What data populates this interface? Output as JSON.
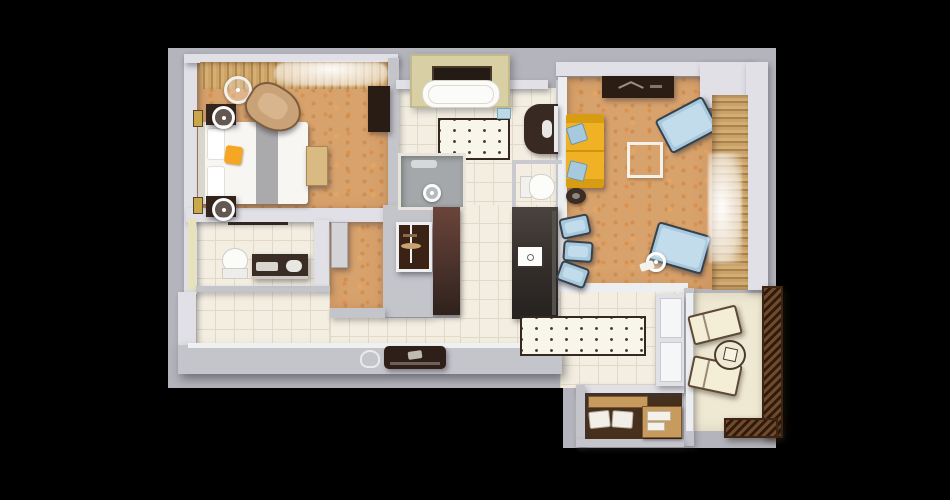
{
  "title": "3D apartment floor plan, top-down view",
  "palette": {
    "background": "#000000",
    "canvas": "#b4b4bc",
    "wall_light": "#e0e0e6",
    "wall_mid": "#c4c4cb",
    "carpet": "#d8a26c",
    "tile": "#f3eee1",
    "tile_line": "#e2dac7",
    "wood": "#c99f63",
    "dark_furniture": "#33241c",
    "sofa_yellow": "#f1b125",
    "chair_blue": "#a7c9de",
    "balcony_floor": "#efe9d4",
    "railing_brown": "#5c3a22",
    "closet_floor": "#47301d",
    "closet_wood": "#c79a5e",
    "accent_orange": "#f5a623",
    "shower_gray": "#a4a8aa"
  },
  "rooms": [
    {
      "name": "bedroom",
      "floor": "orange speckled carpet",
      "furniture": [
        "double bed with white duvet, gray runner and orange cushion",
        "nightstand with round lamp (x2)",
        "gold wall art (x2)",
        "tan armchair",
        "floor lamp",
        "foot bench",
        "dark wardrobe",
        "window strip with wood slats and sheer curtain",
        "gray dresser"
      ]
    },
    {
      "name": "main-bathroom",
      "floor": "cream tile",
      "furniture": [
        "bathtub in alcove with window",
        "dotted bath mat",
        "dark vanity with sink and mirror",
        "blue towel",
        "gray shower",
        "toilet"
      ]
    },
    {
      "name": "second-bathroom",
      "floor": "cream tile",
      "furniture": [
        "toilet",
        "dark vanity with sink",
        "towel rail",
        "white door"
      ]
    },
    {
      "name": "kitchen",
      "floor": "cream tile",
      "furniture": [
        "glass display cabinet",
        "tall brown cabinet",
        "dark island with cooktop",
        "blue bar stool (x3)",
        "dotted runner rug",
        "dark counter appliance",
        "glass kettle"
      ]
    },
    {
      "name": "living-room",
      "floor": "orange speckled carpet",
      "furniture": [
        "dark tv console",
        "yellow sofa with two blue cushions",
        "dark round side table",
        "white coffee table",
        "blue lounge armchair (x2)",
        "chrome floor lamp",
        "curtained window wall"
      ]
    },
    {
      "name": "hallway",
      "floor": "cream tile",
      "furniture": [
        "glazed balcony door"
      ]
    },
    {
      "name": "walk-in-closet",
      "floor": "dark brown",
      "furniture": [
        "wood shelf with folded white clothes",
        "wooden drawer unit"
      ]
    },
    {
      "name": "balcony",
      "floor": "cream deck",
      "furniture": [
        "sun lounger (x2)",
        "round table with cube ornament",
        "dark zigzag railing"
      ]
    }
  ]
}
